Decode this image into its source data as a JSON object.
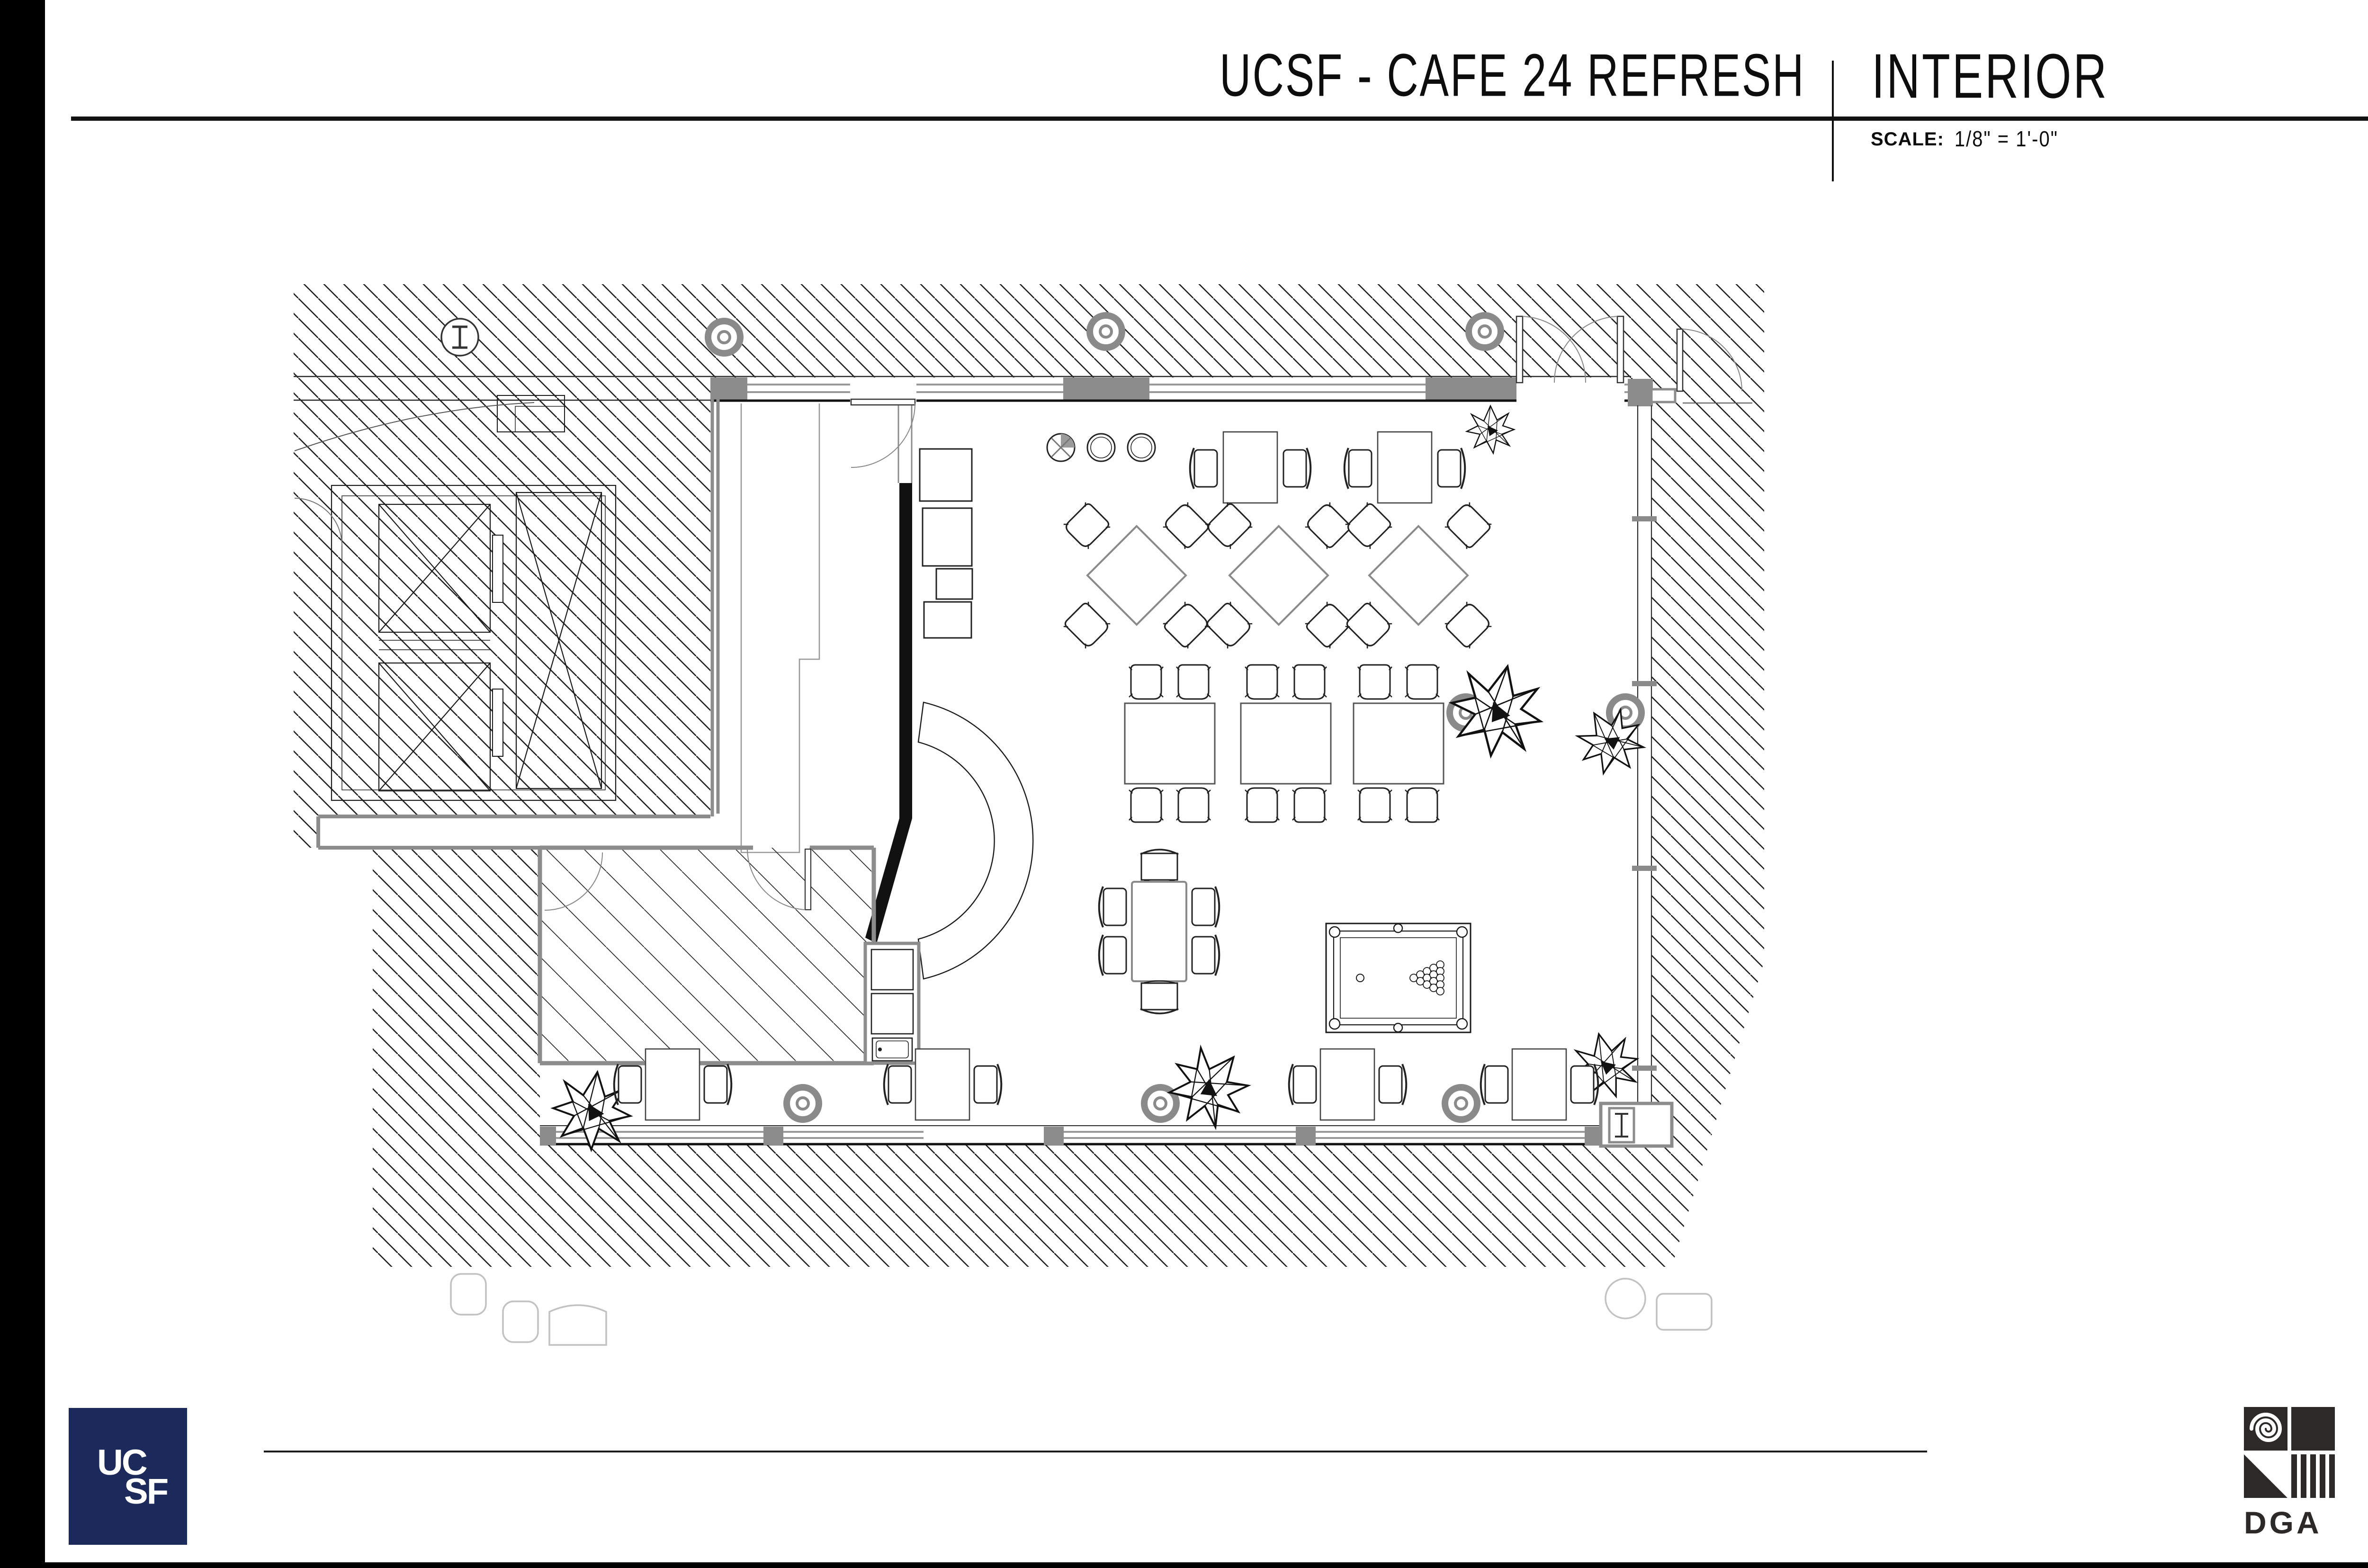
{
  "title_block": {
    "project_title": "UCSF - CAFE 24 REFRESH",
    "sheet_title": "INTERIOR",
    "scale_label": "SCALE:",
    "scale_value": "1/8\" = 1'-0\""
  },
  "footer": {
    "ucsf_logo_line1": "UC",
    "ucsf_logo_line2": "SF",
    "ucsf_logo_color": "#1b2a5b",
    "dga_logo_text": "DGA",
    "dga_logo_color": "#2b2a29"
  },
  "floor_plan": {
    "drawing_type": "interior furniture plan",
    "hatched_zones": [
      "surrounding building core and exterior",
      "elevator core with two x-braced shafts",
      "back-of-house room (light wide hatch)"
    ],
    "rooms": [
      "cafe dining room",
      "servery with counter and equipment line",
      "back-of-house",
      "elevator lobby corridor"
    ],
    "furniture": {
      "round_stools_at_window": 3,
      "two_seat_tables_top_wall": 2,
      "diamond_tables_with_4_chairs": 3,
      "rectangular_tables_with_4_chairs": 3,
      "six_seat_table": 1,
      "pool_table": {
        "count": 1,
        "balls_racked": 15,
        "cue_ball": 1
      },
      "two_seat_tables_bottom_wall": 4,
      "plants": 6,
      "round_columns": 7,
      "i_beam_column_symbols": 2
    },
    "doors": [
      "double outswing doors at top-right",
      "single door right of corner",
      "servery door in top wall",
      "back-of-house doors",
      "lobby door at left edge"
    ],
    "features": [
      "curved crescent wall at servery",
      "black feature wall with angled return",
      "glazed window walls on three sides",
      "kitchenette niche with two cabinets and sink"
    ]
  }
}
